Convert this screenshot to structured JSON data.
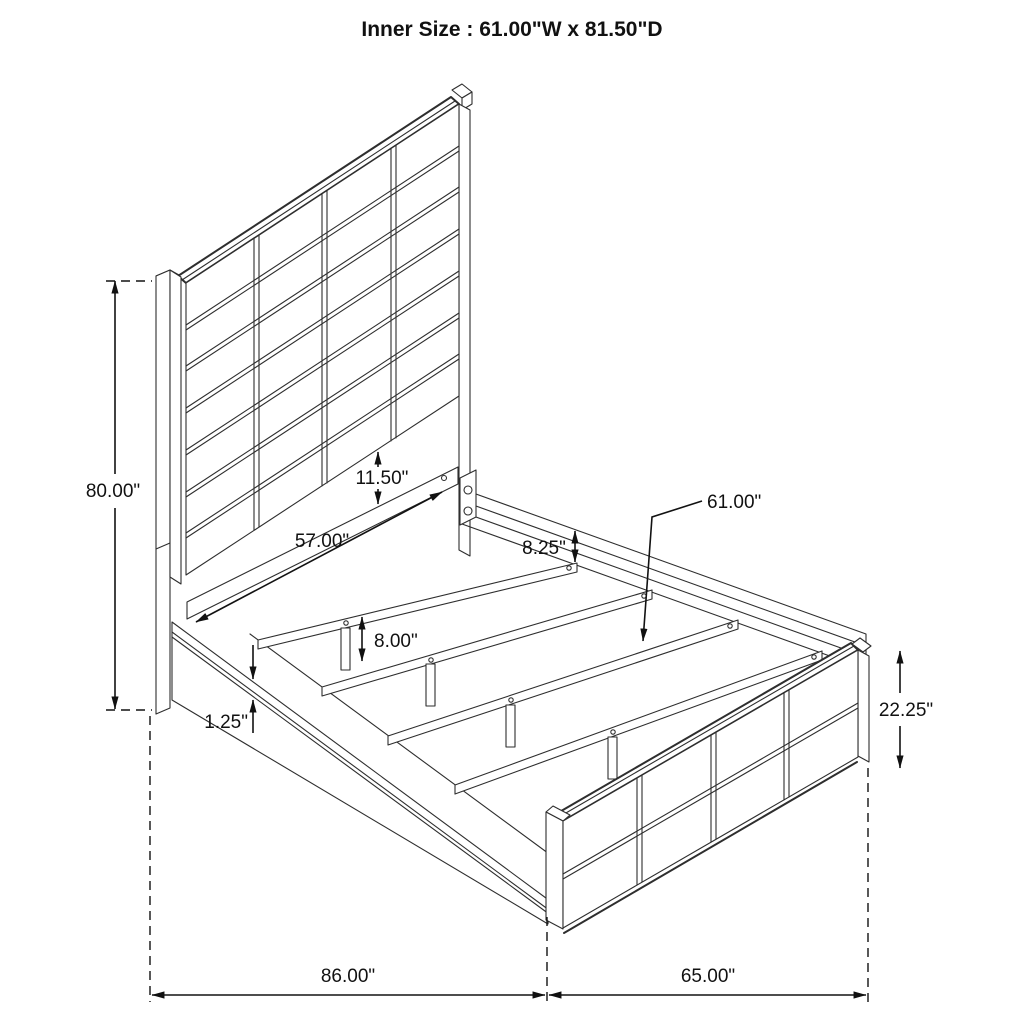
{
  "title": "Inner Size : 61.00\"W x 81.50\"D",
  "annotations": {
    "overall_height": "80.00\"",
    "panel_to_rail_gap": "11.50\"",
    "cross_rail_length": "57.00\"",
    "rail_above_slat": "8.25\"",
    "slat_length": "61.00\"",
    "support_leg_height": "8.00\"",
    "rail_lip_thickness": "1.25\"",
    "footboard_height": "22.25\"",
    "overall_depth": "86.00\"",
    "overall_width": "65.00\""
  }
}
